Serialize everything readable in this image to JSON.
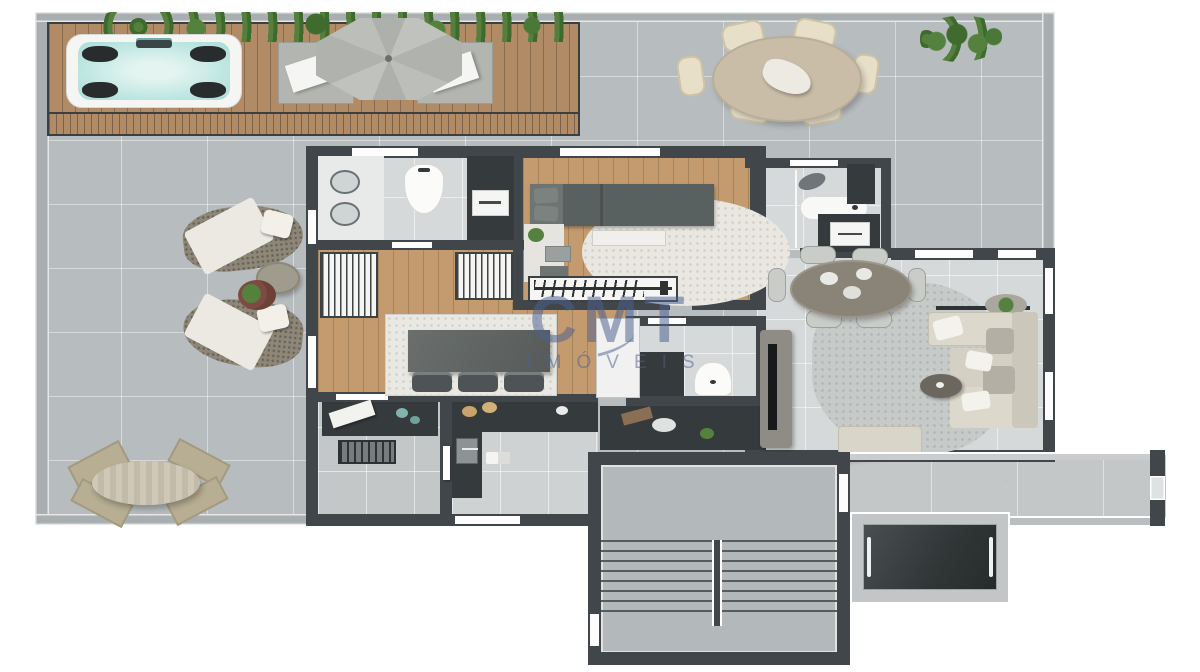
{
  "watermark": {
    "brand": "CMT",
    "subtitle": "IMÓVEIS"
  },
  "palette": {
    "terrace_floor": "#b7bcbe",
    "interior_floor": "#d6d9d9",
    "stair_floor": "#b3b8ba",
    "deck_wood": "#b08b66",
    "interior_wood": "#c39b6f",
    "wall_dark": "#41464a",
    "parapet": "#a9aeb0",
    "fixture_dark": "#353a3d",
    "fixture_white": "#f5f5f3",
    "counter_gray": "#9aa0a1",
    "fabric_cream": "#e3ded0",
    "rug_light": "#e9e7e0",
    "rug_living": "#c6cac8",
    "sofa_cream": "#dcd8cb",
    "plant_green": "#55813f",
    "water_aqua": "#bfe7e2",
    "wood_table": "#c9bda7",
    "watermark_blue": "#4c608f"
  }
}
